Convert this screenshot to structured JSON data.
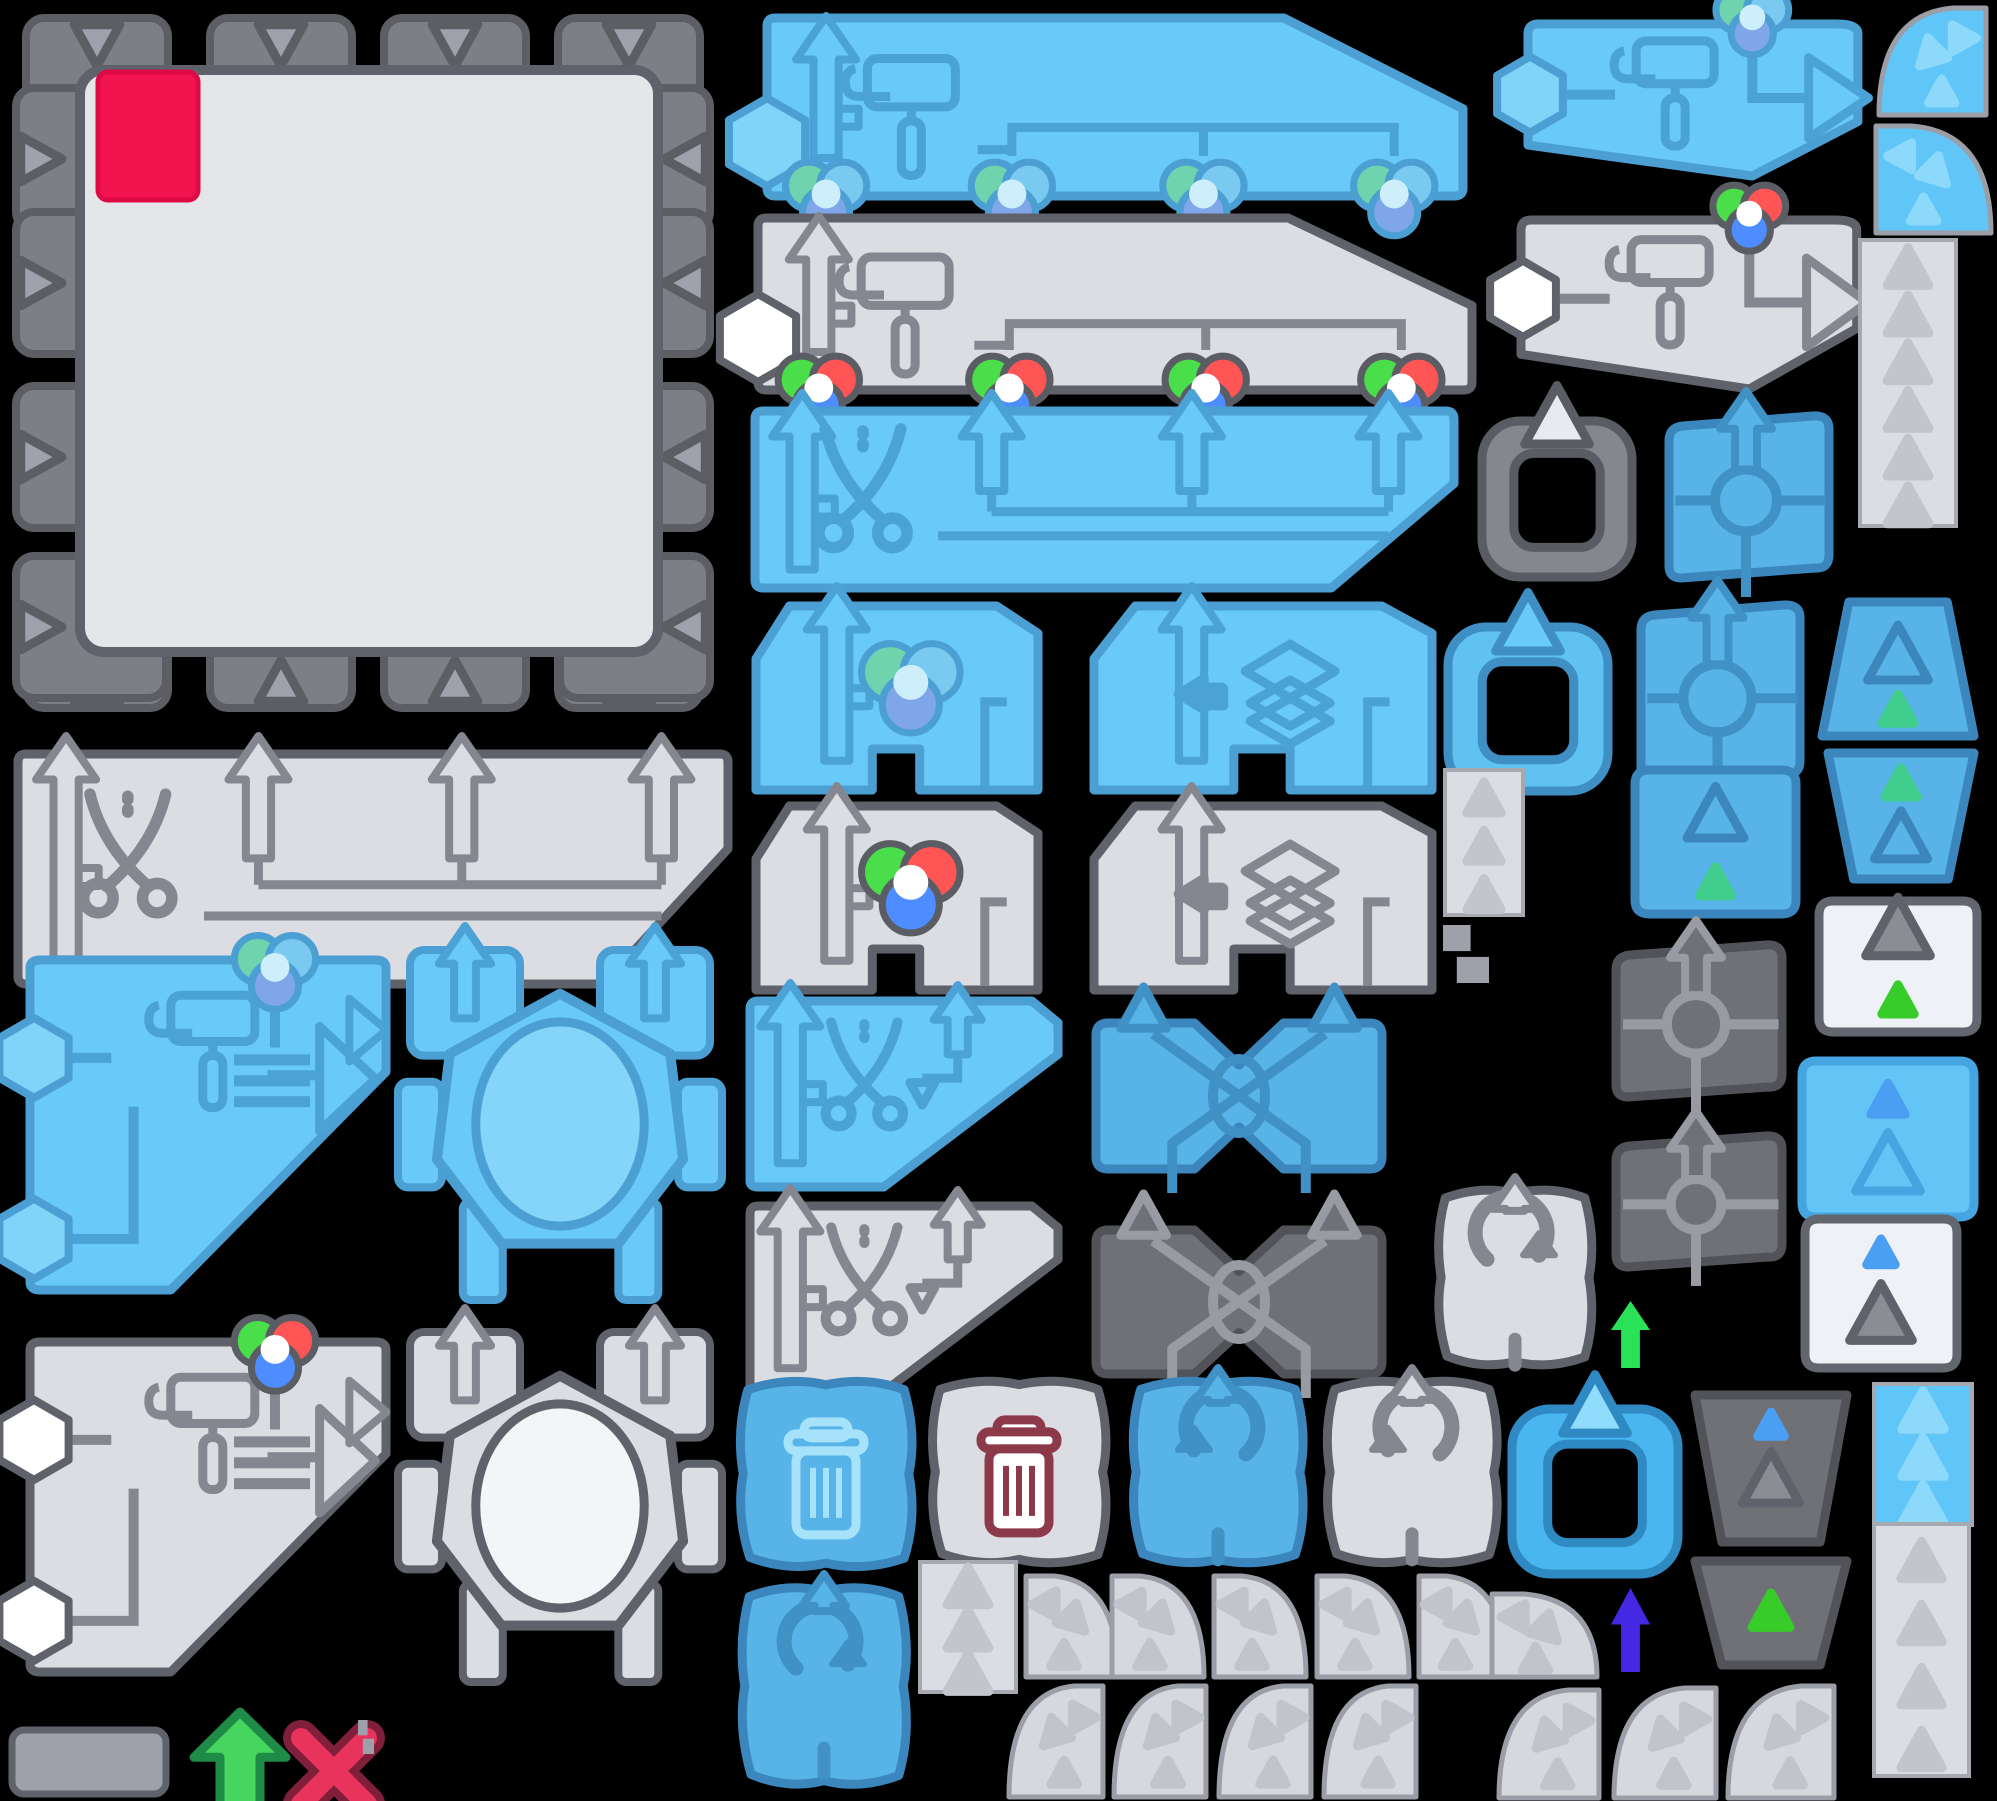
{
  "meta": {
    "title": "game-sprite-atlas",
    "canvas": {
      "w": 1997,
      "h": 1801,
      "bg": "#000000"
    }
  },
  "palette": {
    "schemes": {
      "blue": {
        "fill": "#69C9F8",
        "stroke": "#4C9FD2",
        "icon": "#4BA2D6",
        "hex": "#7FD4FA",
        "ellipse": "#85D5FA",
        "light": "#A6E2FA"
      },
      "blueDeep": {
        "fill": "#58B4E8",
        "stroke": "#3B87BD",
        "icon": "#3F91C6",
        "hex": "#7FD4FA",
        "ellipse": "#85D5FA",
        "light": "#A6E2FA"
      },
      "blueRound": {
        "fill": "#62C5F6",
        "stroke": "#45A5E0",
        "icon": "#4493CD"
      },
      "gray": {
        "fill": "#DBDDE3",
        "stroke": "#5F626A",
        "icon": "#84878F",
        "hex": "#FFFFFF",
        "ellipse": "#F3F5F9",
        "light": "#FFFFFF"
      },
      "dark": {
        "fill": "#6F7177",
        "stroke": "#515359",
        "icon": "#989BA2"
      },
      "white": {
        "fill": "#EEF1F6",
        "stroke": "#63666E",
        "icon": "#84878F"
      },
      "blueQ": {
        "fill": "#5FC6F7",
        "tri": "#8CD9FB"
      },
      "blueS": {
        "fill": "#5FC6F7",
        "tri": "#8CD9FB"
      },
      "quarter": {
        "fill": "#D6D8DE",
        "tri": "#C2C4CC",
        "stroke": "#9B9DA7"
      },
      "grayC": {
        "frame": "#85878F",
        "stroke": "#595C62",
        "tab": "#E8EAEF"
      },
      "blueC": {
        "frame": "#5FC2F2",
        "stroke": "#3F8FC4",
        "tab": "#69C9F8"
      },
      "blueC2": {
        "frame": "#49B6EF",
        "stroke": "#2F89C2",
        "tab": "#8FDCFC"
      },
      "tab": {
        "fill": "#7D7F86",
        "stroke": "#5C5E64",
        "tri": "#9FA2AC"
      },
      "board": {
        "inner": "#E4E6EA",
        "innerStroke": "#5F626A",
        "chip": "#F2134F",
        "chipStroke": "#DE0A46"
      }
    },
    "rgbBright": {
      "outline": "#5A5D63",
      "g": "#4ADE4A",
      "r": "#FF5555",
      "b": "#4D8DFF",
      "center": "#FFFFFF"
    },
    "rgbMuted": {
      "outline": "#4C9FD2",
      "g": "#6FD3AE",
      "r": "#79C9F1",
      "b": "#7FA6E8",
      "center": "#CDEFFB"
    },
    "accents": {
      "greenTri": "#38CC2A",
      "tealTri": "#41CD8E",
      "blueTri": "#4A9FF2",
      "maroon": "#8C3A4A",
      "arrowGreen": "#29E257",
      "arrowGreenOutlined": "#46D65F",
      "arrowGreenStroke": "#1E8C46",
      "arrowPurple": "#4428E4",
      "redX": "#E8335C",
      "redXStroke": "#801F39",
      "bit": "#9EA1A9"
    }
  },
  "sprites": [
    {
      "name": "puzzle-board",
      "kind": "board",
      "x": 10,
      "y": 8,
      "w": 706,
      "h": 706
    },
    {
      "name": "banner-roller-balls-blue",
      "kind": "bannerRoller",
      "x": 757,
      "y": 12,
      "w": 712,
      "h": 186,
      "scheme": "blue",
      "balls": "muted"
    },
    {
      "name": "banner-roller-balls-gray",
      "kind": "bannerRoller",
      "x": 748,
      "y": 212,
      "w": 730,
      "h": 180,
      "scheme": "gray",
      "balls": "bright"
    },
    {
      "name": "banner-scissors-blue",
      "kind": "bannerScissors",
      "x": 745,
      "y": 405,
      "w": 715,
      "h": 187,
      "scheme": "blue"
    },
    {
      "name": "banner-scissors-gray",
      "kind": "bannerScissors",
      "x": 8,
      "y": 748,
      "w": 726,
      "h": 240,
      "scheme": "gray"
    },
    {
      "name": "wedge-color-ball-blue",
      "kind": "wedge",
      "x": 748,
      "y": 600,
      "w": 296,
      "h": 196,
      "scheme": "blue",
      "icon": "ball",
      "balls": "muted"
    },
    {
      "name": "wedge-layers-blue",
      "kind": "wedge",
      "x": 1086,
      "y": 600,
      "w": 352,
      "h": 196,
      "scheme": "blue",
      "icon": "layers"
    },
    {
      "name": "wedge-color-ball-gray",
      "kind": "wedge",
      "x": 748,
      "y": 800,
      "w": 296,
      "h": 196,
      "scheme": "gray",
      "icon": "ball",
      "balls": "bright"
    },
    {
      "name": "wedge-layers-gray",
      "kind": "wedge",
      "x": 1086,
      "y": 800,
      "w": 352,
      "h": 196,
      "scheme": "gray",
      "icon": "layers"
    },
    {
      "name": "wedge-scissors-blue",
      "kind": "wedgeScissors",
      "x": 742,
      "y": 995,
      "w": 322,
      "h": 198,
      "scheme": "blue"
    },
    {
      "name": "wedge-scissors-gray",
      "kind": "wedgeScissors",
      "x": 742,
      "y": 1200,
      "w": 322,
      "h": 198,
      "scheme": "gray"
    },
    {
      "name": "cross-swap-blue",
      "kind": "xshape",
      "x": 1080,
      "y": 1005,
      "w": 318,
      "h": 182,
      "scheme": "blueDeep"
    },
    {
      "name": "cross-swap-dark",
      "kind": "xshape",
      "x": 1080,
      "y": 1212,
      "w": 318,
      "h": 180,
      "scheme": "dark"
    },
    {
      "name": "roller-panel-blue",
      "kind": "rollerBig",
      "x": 22,
      "y": 950,
      "w": 372,
      "h": 348,
      "scheme": "blue",
      "balls": "muted"
    },
    {
      "name": "octagon-panel-blue",
      "kind": "octagon",
      "x": 398,
      "y": 948,
      "w": 324,
      "h": 352,
      "scheme": "blue"
    },
    {
      "name": "roller-panel-gray",
      "kind": "rollerBig",
      "x": 22,
      "y": 1332,
      "w": 372,
      "h": 348,
      "scheme": "gray",
      "balls": "bright"
    },
    {
      "name": "octagon-panel-gray",
      "kind": "octagon",
      "x": 398,
      "y": 1330,
      "w": 324,
      "h": 352,
      "scheme": "gray"
    },
    {
      "name": "small-plate-gray",
      "kind": "rect",
      "x": 8,
      "y": 1726,
      "w": 162,
      "h": 72
    },
    {
      "name": "arrow-up-green-outlined",
      "kind": "freeArrow",
      "x": 190,
      "y": 1708,
      "w": 100,
      "h": 112,
      "fill": "#46D65F",
      "stroke": "#1E8C46"
    },
    {
      "name": "cross-red",
      "kind": "redx",
      "x": 285,
      "y": 1722,
      "w": 98,
      "h": 98
    },
    {
      "name": "tiny-block-a",
      "kind": "bits",
      "x": 358,
      "y": 1720,
      "w": 16,
      "h": 34
    },
    {
      "name": "trash-tile-blue",
      "kind": "squiggle",
      "x": 733,
      "y": 1376,
      "w": 186,
      "h": 196,
      "scheme": "blueDeep",
      "icon": "trash"
    },
    {
      "name": "trash-tile-gray",
      "kind": "squiggle",
      "x": 925,
      "y": 1376,
      "w": 188,
      "h": 192,
      "scheme": "gray",
      "icon": "trashMaroon"
    },
    {
      "name": "rotate-ccw-tile-blue",
      "kind": "squiggle",
      "x": 1126,
      "y": 1376,
      "w": 184,
      "h": 192,
      "scheme": "blueDeep",
      "icon": "rotCCW"
    },
    {
      "name": "rotate-ccw-tile-gray",
      "kind": "squiggle",
      "x": 1320,
      "y": 1376,
      "w": 184,
      "h": 192,
      "scheme": "gray",
      "icon": "rotCCW"
    },
    {
      "name": "rotate-cw-tile-blue",
      "kind": "squiggle",
      "x": 735,
      "y": 1582,
      "w": 178,
      "h": 208,
      "scheme": "blueDeep",
      "icon": "rotCW"
    },
    {
      "name": "rotate-cw-tile-gray",
      "kind": "squiggle",
      "x": 1432,
      "y": 1185,
      "w": 166,
      "h": 185,
      "scheme": "gray",
      "icon": "rotCW"
    },
    {
      "name": "strip-triangles-a",
      "kind": "strip",
      "x": 918,
      "y": 1562,
      "w": 100,
      "h": 130,
      "scheme": "gray",
      "tris": 3
    },
    {
      "name": "quarter-r1-1",
      "kind": "quarter",
      "x": 1022,
      "y": 1572,
      "w": 100,
      "h": 108,
      "scheme": "quarter",
      "corner": "tr"
    },
    {
      "name": "quarter-r1-2",
      "kind": "quarter",
      "x": 1108,
      "y": 1572,
      "w": 100,
      "h": 108,
      "scheme": "quarter",
      "corner": "tr"
    },
    {
      "name": "quarter-r1-3",
      "kind": "quarter",
      "x": 1210,
      "y": 1572,
      "w": 100,
      "h": 108,
      "scheme": "quarter",
      "corner": "tr"
    },
    {
      "name": "quarter-r1-4",
      "kind": "quarter",
      "x": 1313,
      "y": 1572,
      "w": 100,
      "h": 108,
      "scheme": "quarter",
      "corner": "tr"
    },
    {
      "name": "quarter-r1-5",
      "kind": "quarter",
      "x": 1415,
      "y": 1572,
      "w": 96,
      "h": 108,
      "scheme": "quarter",
      "corner": "tr"
    },
    {
      "name": "quarter-r1-6",
      "kind": "quarter",
      "x": 1488,
      "y": 1590,
      "w": 113,
      "h": 90,
      "scheme": "quarter",
      "corner": "tr"
    },
    {
      "name": "quarter-r2-1",
      "kind": "quarter",
      "x": 1005,
      "y": 1682,
      "w": 102,
      "h": 118,
      "scheme": "quarter",
      "corner": "tl"
    },
    {
      "name": "quarter-r2-2",
      "kind": "quarter",
      "x": 1110,
      "y": 1682,
      "w": 100,
      "h": 118,
      "scheme": "quarter",
      "corner": "tl"
    },
    {
      "name": "quarter-r2-3",
      "kind": "quarter",
      "x": 1215,
      "y": 1682,
      "w": 100,
      "h": 118,
      "scheme": "quarter",
      "corner": "tl"
    },
    {
      "name": "quarter-r2-4",
      "kind": "quarter",
      "x": 1320,
      "y": 1682,
      "w": 100,
      "h": 118,
      "scheme": "quarter",
      "corner": "tl"
    },
    {
      "name": "quarter-r2-5",
      "kind": "quarter",
      "x": 1495,
      "y": 1686,
      "w": 108,
      "h": 115,
      "scheme": "quarter",
      "corner": "tl"
    },
    {
      "name": "quarter-r2-6",
      "kind": "quarter",
      "x": 1610,
      "y": 1684,
      "w": 110,
      "h": 117,
      "scheme": "quarter",
      "corner": "tl"
    },
    {
      "name": "quarter-r2-7",
      "kind": "quarter",
      "x": 1724,
      "y": 1682,
      "w": 114,
      "h": 119,
      "scheme": "quarter",
      "corner": "tl"
    },
    {
      "name": "banner-roller-out-blue",
      "kind": "bannerOut",
      "x": 1520,
      "y": 14,
      "w": 352,
      "h": 168,
      "scheme": "blue",
      "balls": "muted"
    },
    {
      "name": "banner-roller-out-gray",
      "kind": "bannerOut",
      "x": 1513,
      "y": 210,
      "w": 358,
      "h": 185,
      "scheme": "gray",
      "balls": "bright"
    },
    {
      "name": "quarter-blue-a",
      "kind": "quarter",
      "x": 1875,
      "y": 4,
      "w": 115,
      "h": 114,
      "scheme": "blueQ",
      "corner": "tl"
    },
    {
      "name": "quarter-blue-b",
      "kind": "quarter",
      "x": 1872,
      "y": 122,
      "w": 123,
      "h": 114,
      "scheme": "blueQ",
      "corner": "tr"
    },
    {
      "name": "strip-triangles-right-tall",
      "kind": "strip",
      "x": 1858,
      "y": 240,
      "w": 100,
      "h": 286,
      "scheme": "gray",
      "tris": 6
    },
    {
      "name": "clipboard-frame-gray",
      "kind": "clipboard",
      "x": 1474,
      "y": 397,
      "w": 166,
      "h": 188,
      "scheme": "grayC"
    },
    {
      "name": "move-tile-blue-a",
      "kind": "move",
      "x": 1653,
      "y": 411,
      "w": 186,
      "h": 172,
      "scheme": "blueDeep"
    },
    {
      "name": "clipboard-frame-blue",
      "kind": "clipboard",
      "x": 1440,
      "y": 603,
      "w": 176,
      "h": 196,
      "scheme": "blueC"
    },
    {
      "name": "move-tile-blue-b",
      "kind": "move",
      "x": 1625,
      "y": 600,
      "w": 185,
      "h": 189,
      "scheme": "blueDeep"
    },
    {
      "name": "trapezoid-blue-up",
      "kind": "trap",
      "x": 1816,
      "y": 594,
      "w": 164,
      "h": 150,
      "scheme": "blueDeep",
      "dir": "up",
      "tris": [
        {
          "t": "outline",
          "cy": 0.42,
          "s": 32
        },
        {
          "t": "fill",
          "c": "#41CD8E",
          "cy": 0.78,
          "s": 17
        }
      ]
    },
    {
      "name": "trapezoid-blue-down",
      "kind": "trap",
      "x": 1822,
      "y": 745,
      "w": 158,
      "h": 142,
      "scheme": "blueDeep",
      "dir": "down",
      "tris": [
        {
          "t": "fill",
          "c": "#41CD8E",
          "cy": 0.28,
          "s": 17
        },
        {
          "t": "outline",
          "cy": 0.66,
          "s": 28
        }
      ]
    },
    {
      "name": "tile-white-green-triangle",
      "kind": "trap",
      "x": 1809,
      "y": 893,
      "w": 178,
      "h": 147,
      "scheme": "white",
      "dir": "square",
      "tris": [
        {
          "t": "outlineGray",
          "cy": 0.26,
          "s": 34
        },
        {
          "t": "fill",
          "c": "#38CC2A",
          "cy": 0.74,
          "s": 17
        }
      ]
    },
    {
      "name": "tile-blue-triangles",
      "kind": "trap",
      "x": 1792,
      "y": 1053,
      "w": 192,
      "h": 172,
      "scheme": "blueRound",
      "dir": "square",
      "tris": [
        {
          "t": "fill",
          "c": "#4A9FF2",
          "cy": 0.28,
          "s": 18
        },
        {
          "t": "outline",
          "cy": 0.66,
          "s": 34
        }
      ]
    },
    {
      "name": "tile-blue-green-triangle",
      "kind": "trap",
      "x": 1625,
      "y": 762,
      "w": 181,
      "h": 160,
      "scheme": "blueDeep",
      "dir": "square",
      "tris": [
        {
          "t": "outline",
          "cy": 0.34,
          "s": 30
        },
        {
          "t": "fill",
          "c": "#41CD8E",
          "cy": 0.76,
          "s": 17
        }
      ]
    },
    {
      "name": "strip-triangles-b",
      "kind": "strip",
      "x": 1443,
      "y": 770,
      "w": 82,
      "h": 145,
      "scheme": "gray",
      "tris": 3
    },
    {
      "name": "tiny-block-b",
      "kind": "bits",
      "x": 1443,
      "y": 925,
      "w": 46,
      "h": 58
    },
    {
      "name": "move-tile-dark-a",
      "kind": "move",
      "x": 1600,
      "y": 940,
      "w": 192,
      "h": 162,
      "scheme": "dark"
    },
    {
      "name": "move-tile-dark-b",
      "kind": "move",
      "x": 1600,
      "y": 1131,
      "w": 192,
      "h": 141,
      "scheme": "dark"
    },
    {
      "name": "tile-white-blue-triangle",
      "kind": "trap",
      "x": 1795,
      "y": 1211,
      "w": 172,
      "h": 165,
      "scheme": "white",
      "dir": "square",
      "tris": [
        {
          "t": "fill",
          "c": "#4A9FF2",
          "cy": 0.26,
          "s": 15
        },
        {
          "t": "outlineGray",
          "cy": 0.64,
          "s": 33
        }
      ]
    },
    {
      "name": "arrow-up-green",
      "kind": "freeArrow",
      "x": 1607,
      "y": 1297,
      "w": 47,
      "h": 75,
      "fill": "#29E257"
    },
    {
      "name": "clipboard-frame-blue-b",
      "kind": "clipboard",
      "x": 1504,
      "y": 1385,
      "w": 182,
      "h": 197,
      "scheme": "blueC2"
    },
    {
      "name": "trapezoid-dark-a",
      "kind": "trap",
      "x": 1689,
      "y": 1387,
      "w": 164,
      "h": 163,
      "scheme": "dark",
      "dir": "down",
      "tris": [
        {
          "t": "fill",
          "c": "#4A9FF2",
          "cy": 0.24,
          "s": 14
        },
        {
          "t": "outlineGray",
          "cy": 0.58,
          "s": 30
        }
      ]
    },
    {
      "name": "trapezoid-dark-b",
      "kind": "trap",
      "x": 1689,
      "y": 1553,
      "w": 164,
      "h": 120,
      "scheme": "dark",
      "dir": "down",
      "tris": [
        {
          "t": "fill",
          "c": "#38CC2A",
          "cy": 0.5,
          "s": 20
        }
      ]
    },
    {
      "name": "strip-triangles-blue",
      "kind": "strip",
      "x": 1872,
      "y": 1384,
      "w": 102,
      "h": 141,
      "scheme": "blueS",
      "tris": 3
    },
    {
      "name": "strip-triangles-c",
      "kind": "strip",
      "x": 1872,
      "y": 1524,
      "w": 99,
      "h": 252,
      "scheme": "gray",
      "tris": 4
    },
    {
      "name": "arrow-up-purple",
      "kind": "freeArrow",
      "x": 1607,
      "y": 1584,
      "w": 47,
      "h": 92,
      "fill": "#4428E4"
    }
  ]
}
